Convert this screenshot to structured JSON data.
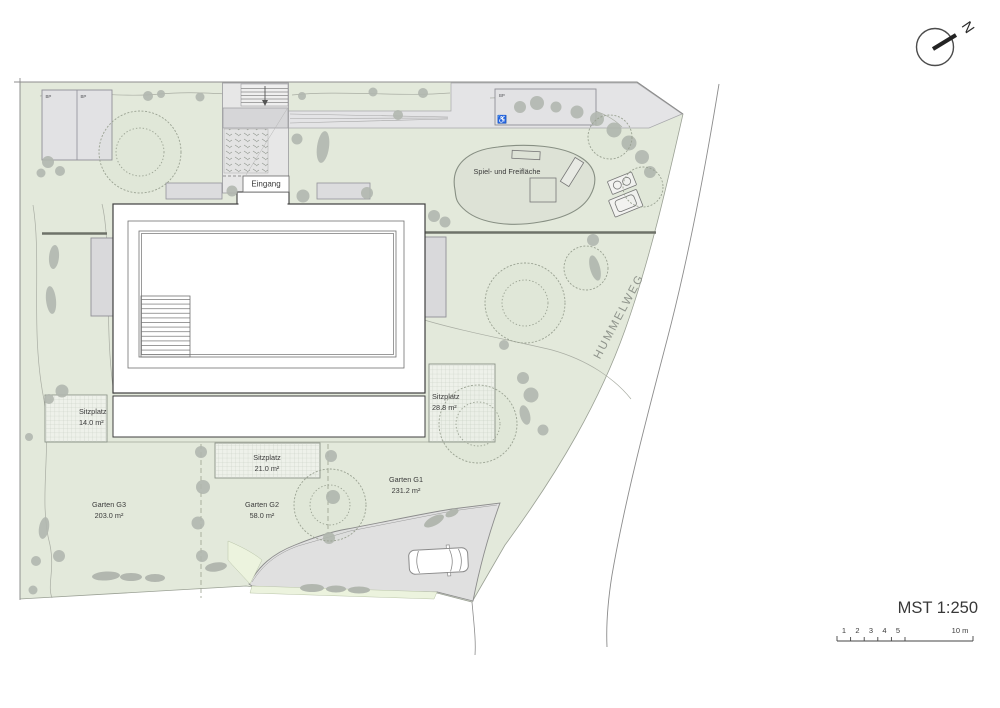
{
  "plan": {
    "scale": {
      "label": "MST 1:250",
      "ticks": [
        "1",
        "2",
        "3",
        "4",
        "5"
      ],
      "end": "10 m"
    },
    "north": "N",
    "street": "HUMMELWEG",
    "entrance": "Eingang",
    "playground": "Spiel- und Freifläche",
    "parking_stall": "BP",
    "accessible_icon": "♿",
    "seat_label": "Sitzplatz",
    "seats": {
      "s14": "14.0 m²",
      "s21": "21.0 m²",
      "s28": "28.8 m²"
    },
    "gardens": {
      "g1": {
        "name": "Garten G1",
        "area": "231.2 m²"
      },
      "g2": {
        "name": "Garten G2",
        "area": "58.0 m²"
      },
      "g3": {
        "name": "Garten G3",
        "area": "203.0 m²"
      }
    },
    "colors": {
      "site_green": "#e3e9db",
      "light_green": "#ecf3de",
      "paving": "#e4e4e6",
      "driveway": "#e0e0e0",
      "playground_fill": "#dde2d6",
      "tree_gray": "#b2b7af",
      "building_outline": "#3f3f3f"
    }
  }
}
